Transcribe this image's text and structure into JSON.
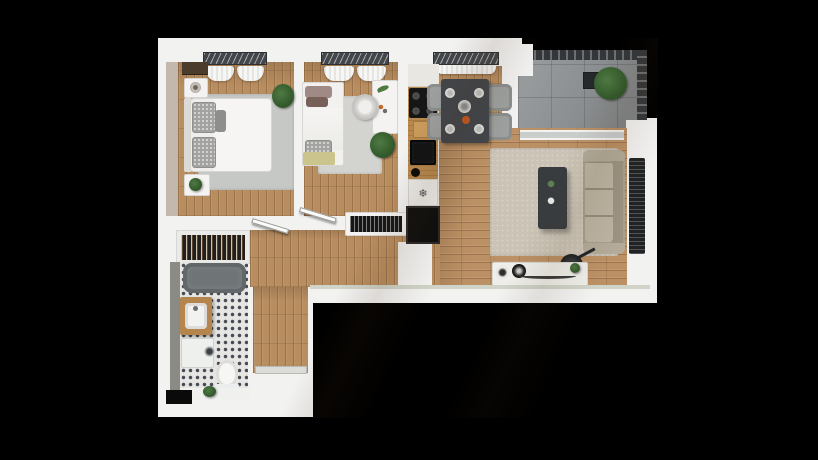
{
  "scene": {
    "kind": "3d-floor-plan-render",
    "background": "#000000"
  },
  "icons": {
    "freezer_snowflake": "❄"
  },
  "palette": {
    "walls": "#f2f2f1",
    "wood_floor": "#b88d5f",
    "balcony_concrete": "#8f9395",
    "balcony_railing": "#34373a",
    "bathroom_tile": "#e6e6e4",
    "bathtub": "#7d8385",
    "kitchen_counter": "#b8894e",
    "appliance_black": "#121212",
    "dining_table": "#41454a",
    "sofa": "#b3aa99",
    "living_rug": "#cbc4b6",
    "bedroom_rug": "#c6c8c5",
    "plant_green": "#3d6637",
    "window_frame": "#43464a",
    "curtain_white": "#f6f6f4"
  }
}
